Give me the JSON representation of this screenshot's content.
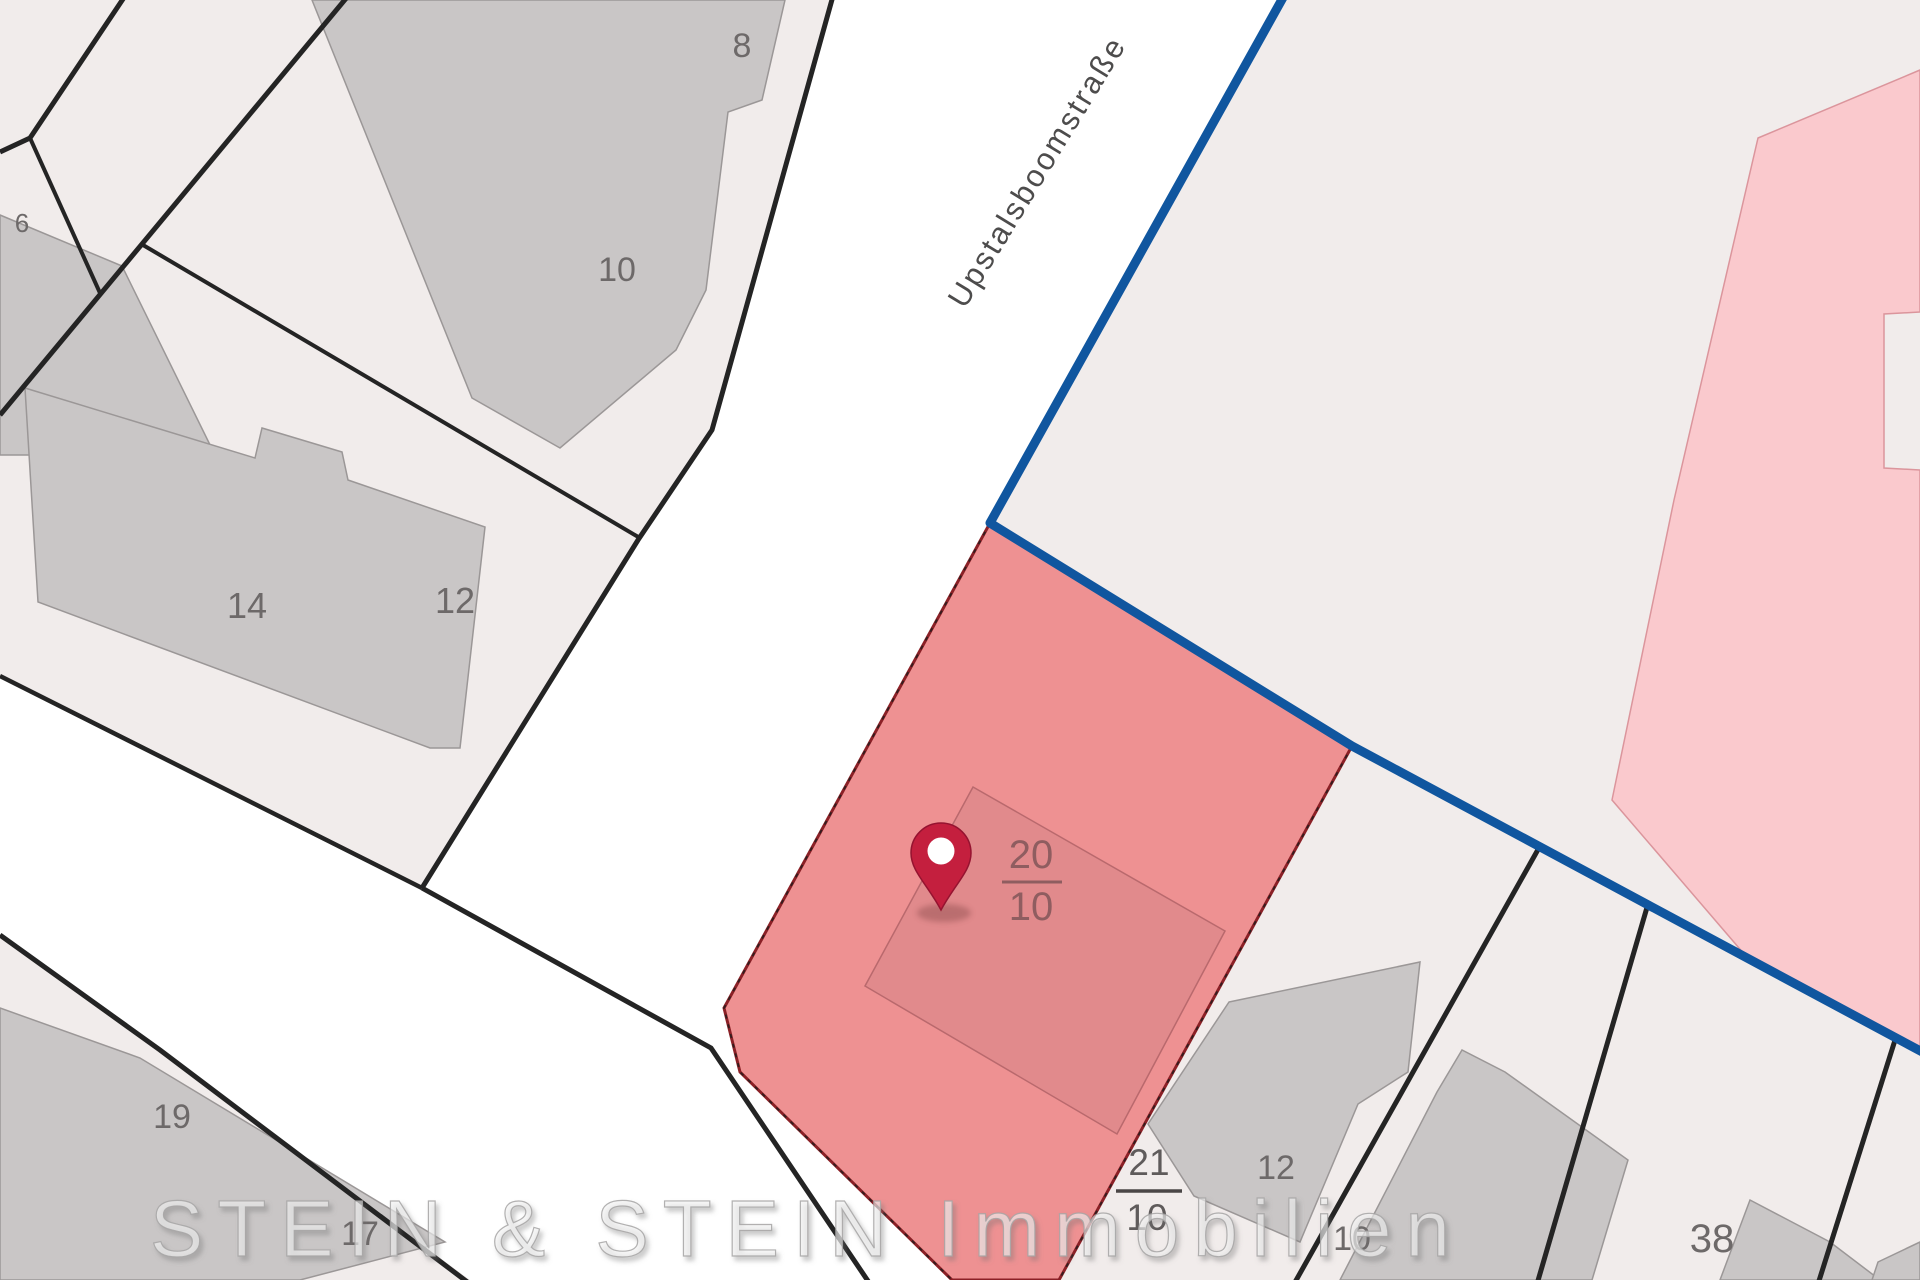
{
  "map": {
    "street_name": "Upstalsboomstraße",
    "watermark": "STEIN & STEIN Immobilien",
    "highlighted_parcel": {
      "numerator": "20",
      "denominator": "10"
    },
    "neighbor_parcel": {
      "numerator": "21",
      "denominator": "10"
    },
    "house_numbers": {
      "h6": "6",
      "h8": "8",
      "h10": "10",
      "h12": "12",
      "h14": "14",
      "h19": "19",
      "h17": "17",
      "h12b": "12",
      "h10b": "10",
      "h38": "38"
    },
    "icons": {
      "marker": "location-pin-icon"
    },
    "colors": {
      "street_white": "#ffffff",
      "parcel_fill": "#f1eceb",
      "building_fill": "#c9c6c6",
      "building_outline": "#9b9797",
      "boundary_black": "#242424",
      "boundary_blue": "#10569f",
      "pink_area_fill": "#fac9cd",
      "pink_area_edge": "#db959c",
      "highlight_fill": "#ee9192",
      "highlight_edge": "#8b2026",
      "highlight_building_fill": "#e18a8c",
      "highlight_building_edge": "#b9696d",
      "pin_red": "#c41f3e",
      "label_gray": "#6d6969",
      "label_red": "#8f5d60"
    }
  }
}
